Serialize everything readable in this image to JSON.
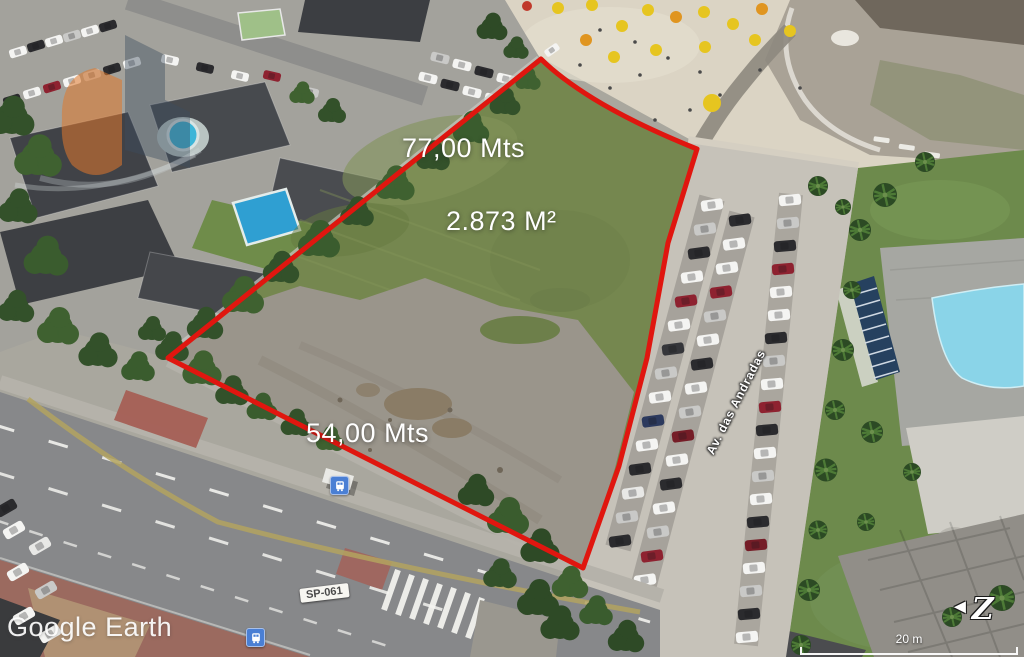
{
  "canvas": {
    "width": 1024,
    "height": 657
  },
  "map": {
    "provider_watermark": "Google Earth",
    "scale_bar_label": "20 m",
    "compass": {
      "arrow_glyph": "◄",
      "north_letter": "Z"
    }
  },
  "property": {
    "outline_color": "#e0160f",
    "front_length_label": "77,00 Mts",
    "area_label": "2.873 M²",
    "side_length_label": "54,00 Mts"
  },
  "streets": {
    "avenue_name": "Av. das Andradas",
    "highway_code": "SP-061"
  },
  "markers": {
    "bus_stop_icons": [
      "bus-stop-icon",
      "bus-stop-icon"
    ]
  },
  "watermark_logo": {
    "orange": "#e0782b",
    "slate": "#3c4c60"
  }
}
